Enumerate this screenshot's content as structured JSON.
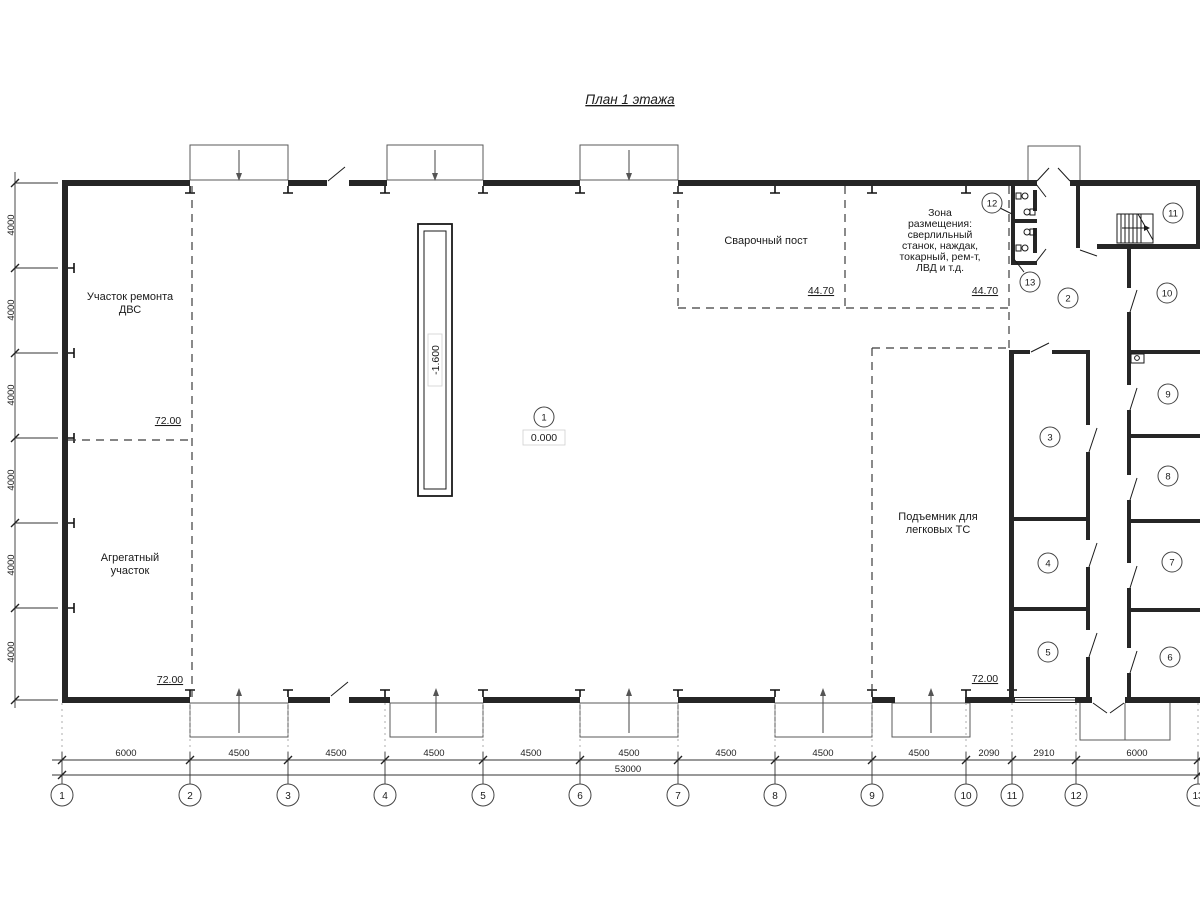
{
  "title": "План 1 этажа",
  "labels": {
    "engine_repair_1": "Участок ремонта",
    "engine_repair_2": "ДВС",
    "aggregate_1": "Агрегатный",
    "aggregate_2": "участок",
    "welding": "Сварочный пост",
    "zone_1": "Зона",
    "zone_2": "размещения:",
    "zone_3": "сверлильный",
    "zone_4": "станок, наждак,",
    "zone_5": "токарный, рем-т,",
    "zone_6": "ЛВД и т.д.",
    "lift_1": "Подъемник для",
    "lift_2": "легковых ТС"
  },
  "elevations": {
    "floor_mid_left": "72.00",
    "floor_bottom_left": "72.00",
    "floor_bottom_right": "72.00",
    "welding_left": "44.70",
    "welding_right": "44.70",
    "main_level": "0.000",
    "pit_depth": "-1.600"
  },
  "rooms": [
    "1",
    "2",
    "3",
    "4",
    "5",
    "6",
    "7",
    "8",
    "9",
    "10",
    "11",
    "12",
    "13"
  ],
  "axes": [
    "1",
    "2",
    "3",
    "4",
    "5",
    "6",
    "7",
    "8",
    "9",
    "10",
    "11",
    "12",
    "13"
  ],
  "dimensions": {
    "bottom_segments": [
      "6000",
      "4500",
      "4500",
      "4500",
      "4500",
      "4500",
      "4500",
      "4500",
      "4500",
      "2090",
      "2910",
      "6000"
    ],
    "bottom_total": "53000",
    "left_segments": [
      "4000",
      "4000",
      "4000",
      "4000",
      "4000",
      "4000"
    ]
  }
}
